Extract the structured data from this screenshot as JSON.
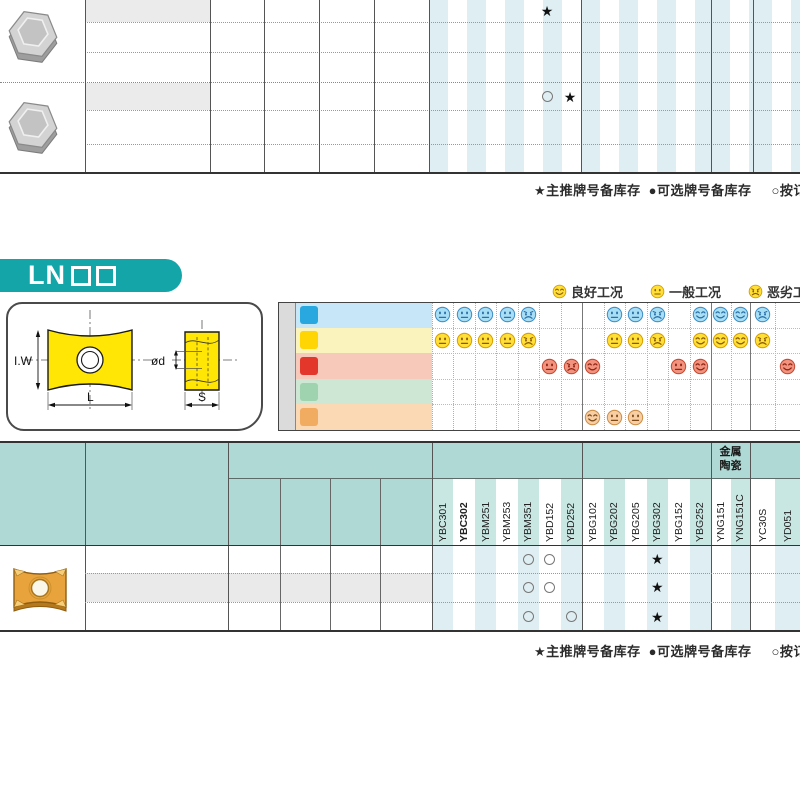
{
  "colors": {
    "banner_teal": "#14A5A8",
    "header_teal": "#AFD9D5",
    "header_col_tint": "#C8E6E2",
    "stripe_blue": "#DEEEF3",
    "row_shade": "#EAEAEA",
    "model_cell_shade": "#EBEBEB",
    "side_label_bg": "#DBDBDB",
    "line_dark": "#333333",
    "legend_face": {
      "f": "#FFDF38",
      "s": "#D69F00",
      "k": "#8A5A00"
    }
  },
  "symbols": {
    "star": "★"
  },
  "top_table": {
    "rows": [
      {
        "model": "HNEX090512-DM",
        "dims": [
          "9.16",
          "15.875",
          "5.56",
          "1.2"
        ],
        "markers": [
          {
            "x": 547,
            "kind": "star"
          }
        ]
      },
      {
        "model": "HNEX090512-DR",
        "dims": [
          "9.16",
          "15.875",
          "5.56",
          "1.2"
        ],
        "markers": [
          {
            "x": 547,
            "kind": "circle"
          },
          {
            "x": 570,
            "kind": "star"
          }
        ]
      }
    ]
  },
  "stock_legend": {
    "star": "★主推牌号备库存",
    "dot": "●可选牌号备库存",
    "circle": "○按订单"
  },
  "section_banner": {
    "text": "LN",
    "boxes": "□□"
  },
  "condition_legend": [
    {
      "kind": "good",
      "label": "良好工况"
    },
    {
      "kind": "fair",
      "label": "一般工况"
    },
    {
      "kind": "poor",
      "label": "恶劣工况"
    }
  ],
  "drawing_labels": {
    "iw": "I.W",
    "l": "L",
    "od": "ød",
    "s": "S"
  },
  "material_table": {
    "side_label": "工件材料",
    "rows": [
      {
        "code": "P",
        "name": "钢",
        "icon_bg": "#29A8E0",
        "icon_fg": "#ffffff",
        "row_bg": "#C7E6F7",
        "face": {
          "f": "#A9DFF5",
          "s": "#3F8EC6",
          "k": "#2B6FA8"
        },
        "cells": {
          "YBC301": "fair",
          "YBC302": "fair",
          "YBM251": "fair",
          "YBM253": "fair",
          "YBM351": "poor",
          "YBG202": "fair",
          "YBG205": "fair",
          "YBG302": "poor",
          "YBG252": "good",
          "YNG151": "good",
          "YNG151C": "good",
          "YC30S": "poor"
        }
      },
      {
        "code": "M",
        "name": "不锈钢",
        "icon_bg": "#FFD503",
        "icon_fg": "#111111",
        "row_bg": "#FBF3BE",
        "face": {
          "f": "#FFDF38",
          "s": "#D69F00",
          "k": "#8A5A00"
        },
        "cells": {
          "YBC301": "fair",
          "YBC302": "fair",
          "YBM251": "fair",
          "YBM253": "fair",
          "YBM351": "poor",
          "YBG202": "fair",
          "YBG205": "fair",
          "YBG302": "poor",
          "YBG252": "good",
          "YNG151": "good",
          "YNG151C": "good",
          "YC30S": "poor"
        }
      },
      {
        "code": "K",
        "name": "铸铁",
        "icon_bg": "#E4372B",
        "icon_fg": "#ffffff",
        "row_bg": "#F6C9BA",
        "face": {
          "f": "#F2937F",
          "s": "#C14B34",
          "k": "#8F2412"
        },
        "cells": {
          "YBD152": "fair",
          "YBD252": "poor",
          "YBG102": "good",
          "YBG152": "fair",
          "YBG252": "good",
          "YD051": "good"
        }
      },
      {
        "code": "N",
        "name": "有色金属",
        "icon_bg": "#9FD2AE",
        "icon_fg": "#ffffff",
        "row_bg": "#CDE7D4",
        "face": {
          "f": "#BFE3C8",
          "s": "#5F9E74",
          "k": "#3C7A52"
        },
        "cells": {}
      },
      {
        "code": "S",
        "name": "耐热合金、钛合金",
        "icon_bg": "#F2AC62",
        "icon_fg": "#ffffff",
        "row_bg": "#FAD9B4",
        "face": {
          "f": "#F8CFA4",
          "s": "#CE8F47",
          "k": "#7E4B17"
        },
        "cells": {
          "YBG102": "good",
          "YBG202": "fair",
          "YBG205": "fair"
        }
      }
    ]
  },
  "insert_table": {
    "headers": {
      "shape": "刀片外形",
      "model": "型 号",
      "dims_group": "基本尺寸(mm)",
      "dims": [
        "L",
        "I.W",
        "S",
        "ød"
      ]
    },
    "grade_groups": [
      {
        "name": "CVD涂层",
        "grades": [
          "YBC301",
          "YBC302",
          "YBM251",
          "YBM253",
          "YBM351",
          "YBD152",
          "YBD252"
        ]
      },
      {
        "name": "PVD涂层",
        "grades": [
          "YBG102",
          "YBG202",
          "YBG205",
          "YBG302",
          "YBG152",
          "YBG252"
        ]
      },
      {
        "name": "金属陶瓷",
        "grades": [
          "YNG151",
          "YNG151C"
        ],
        "two_line": [
          "金属",
          "陶瓷"
        ]
      },
      {
        "name": "硬质合金",
        "grades": [
          "YC30S",
          "YD051"
        ]
      }
    ],
    "bold_grades": [
      "YBC302"
    ],
    "rows": [
      {
        "model": "LNKT1506EN-ZR",
        "dims": [
          "15.875",
          "14",
          "6.35",
          "4.6"
        ],
        "shaded": false,
        "markers": {
          "YBM351": "circle",
          "YBD152": "circle",
          "YBG302": "star"
        }
      },
      {
        "model": "LNKT2007DN-ZR",
        "dims": [
          "20",
          "17",
          "7.94",
          "4.6"
        ],
        "shaded": true,
        "markers": {
          "YBM351": "circle",
          "YBD152": "circle",
          "YBG302": "star"
        }
      },
      {
        "model": "LNKT2510-ZR",
        "dims": [
          "25",
          "18",
          "9.525",
          "5.5"
        ],
        "shaded": false,
        "markers": {
          "YBM351": "circle",
          "YBD252": "circle",
          "YBG302": "star"
        }
      }
    ]
  }
}
